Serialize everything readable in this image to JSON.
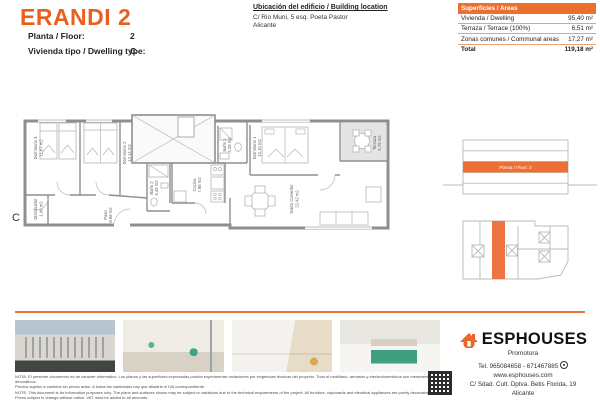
{
  "header": {
    "title": "ERANDI 2",
    "fields": [
      {
        "label": "Planta / Floor:",
        "value": "2"
      },
      {
        "label": "Vivienda tipo / Dwelling type:",
        "value": "C"
      }
    ],
    "location": {
      "title": "Ubicación del edificio / Building location",
      "line1": "C/ Rio Muni, 5 esq. Poeta Pastor",
      "line2": "Alicante"
    },
    "areas": {
      "header": "Superficies / Areas",
      "rows": [
        {
          "label": "Vivienda / Dwelling",
          "value": "95,40 m²"
        },
        {
          "label": "Terraza / Terrace (100%)",
          "value": "6,51 m²"
        },
        {
          "label": "Zonas comunes / Communal areas",
          "value": "17,27 m²"
        }
      ],
      "total_label": "Total",
      "total_value": "119,18 m²"
    }
  },
  "floorplan": {
    "type_letter": "C",
    "rooms": [
      {
        "name": "Dormitorio 3",
        "area": "11.67 m2"
      },
      {
        "name": "Dormitorio 2",
        "area": "12.14 m2"
      },
      {
        "name": "Dormitorio 1",
        "area": "12.10 m2"
      },
      {
        "name": "Baño 1",
        "area": "4.29 m2"
      },
      {
        "name": "Baño 2",
        "area": "3.49 m2"
      },
      {
        "name": "Cocina",
        "area": "7.98 m2"
      },
      {
        "name": "Salón Comedor",
        "area": "22.42 m2"
      },
      {
        "name": "Terraza",
        "area": "5.79 m2"
      },
      {
        "name": "Distribuidor",
        "area": "1.46 m2"
      },
      {
        "name": "Paso",
        "area": "8.98 m2"
      }
    ]
  },
  "side": {
    "floor_band": "Planta / Floor: 2"
  },
  "footer": {
    "disclaimer_es_1": "NOTA: El presente documento es de carácter informativo. Los planos y las superficies expresadas podrán experimentar variaciones por exigencias técnicas del proyecto. Todo el mobiliario, armarios y electrodomésticos son meramente decorativos.",
    "disclaimer_es_2": "Precios sujetos a cambios sin previo aviso. A todas las cantidades hay que añadirle el IVA correspondiente.",
    "disclaimer_en_1": "NOTE: This document is for information purposes only. The plans and surfaces shown may be subject to variations due to the technical requirements of the project. All furniture, cupboards and electrical appliances are purely decorative.",
    "disclaimer_en_2": "Prices subject to change without notice. VAT must be added to all amounts.",
    "brand": {
      "name": "ESPHOUSES",
      "tagline": "Promotora",
      "tel": "Tel. 965084658 - 671467885",
      "web": "www.esphouses.com",
      "address1": "C/ Sdad. Cult. Dptva. Betis Florida, 19",
      "address2": "Alicante"
    }
  },
  "colors": {
    "accent": "#e8601f",
    "table_orange": "#ed6f2f"
  }
}
